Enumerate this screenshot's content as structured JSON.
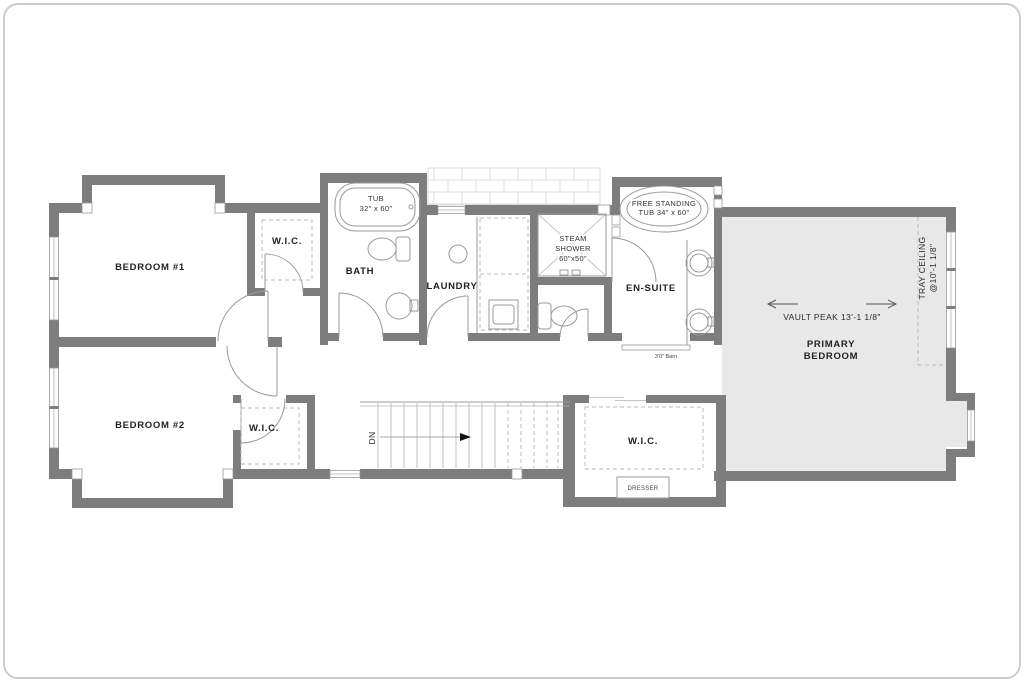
{
  "colors": {
    "wall": "#7d7d7d",
    "room_fill": "#e8e8e8",
    "line": "#9a9a9a",
    "dash": "#b7b7b7",
    "text": "#222222",
    "page_border": "#cccccc",
    "brick_line": "#dedede"
  },
  "labels": {
    "bedroom1": "BEDROOM #1",
    "bedroom2": "BEDROOM #2",
    "wic1": "W.I.C.",
    "wic2": "W.I.C.",
    "wic3": "W.I.C.",
    "bath": "BATH",
    "laundry": "LAUNDRY",
    "ensuite": "EN-SUITE",
    "tub_line1": "TUB",
    "tub_line2": "32\" x 60\"",
    "steam_line1": "STEAM",
    "steam_line2": "SHOWER",
    "steam_line3": "60\"x50\"",
    "fs_tub_line1": "FREE STANDING",
    "fs_tub_line2": "TUB 34\" x 60\"",
    "vault_peak": "VAULT PEAK 13'-1 1/8\"",
    "primary_line1": "PRIMARY",
    "primary_line2": "BEDROOM",
    "tray_line1": "TRAY CEILING",
    "tray_line2": "@10'-1 1/8\"",
    "dn": "DN",
    "barn_door": "3'0\" Barn",
    "dresser": "DRESSER"
  }
}
